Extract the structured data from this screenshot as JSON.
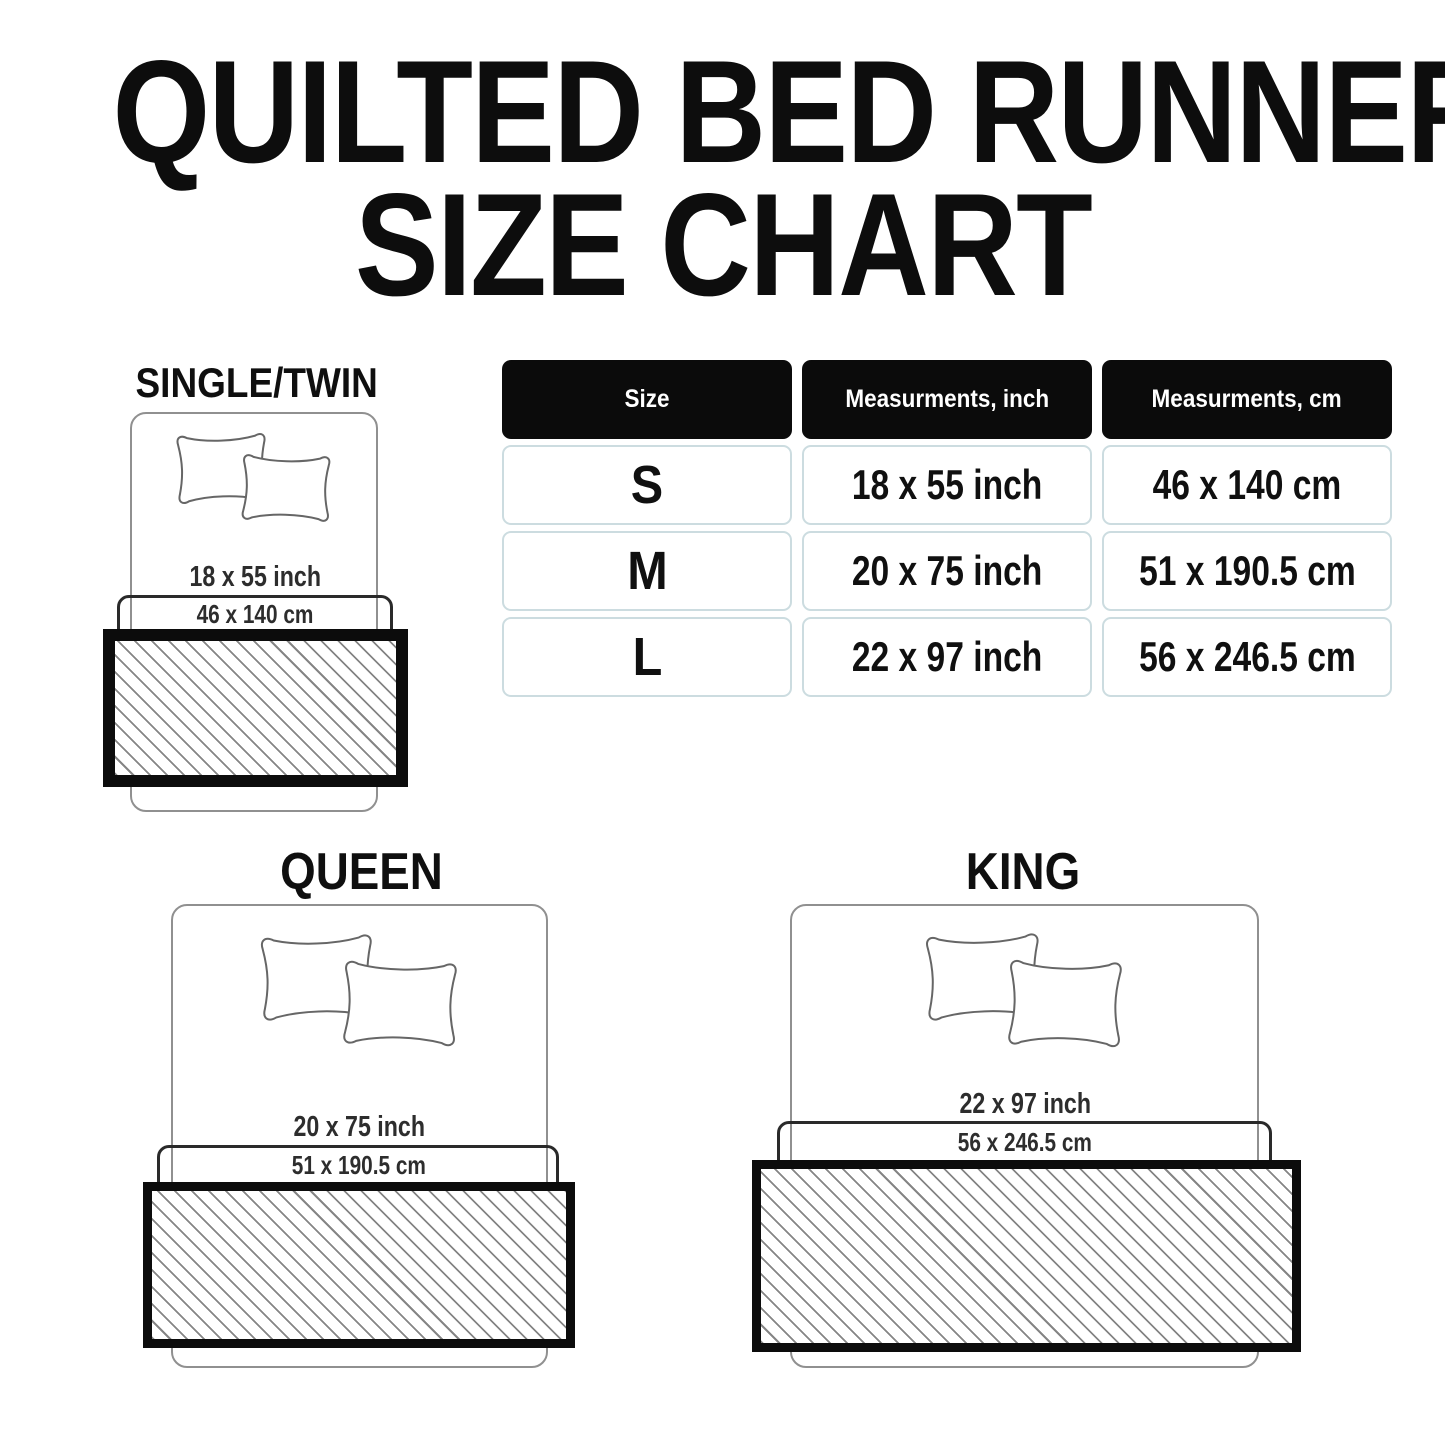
{
  "title": {
    "line1": "QUILTED BED RUNNER",
    "line2": "SIZE CHART"
  },
  "table": {
    "headers": [
      "Size",
      "Measurments, inch",
      "Measurments, cm"
    ],
    "rows": [
      {
        "size": "S",
        "inch": "18 x 55 inch",
        "cm": "46 x 140 cm"
      },
      {
        "size": "M",
        "inch": "20 x 75 inch",
        "cm": "51 x 190.5 cm"
      },
      {
        "size": "L",
        "inch": "22 x 97 inch",
        "cm": "56 x 246.5 cm"
      }
    ]
  },
  "diagrams": {
    "single": {
      "label": "SINGLE/TWIN",
      "inch": "18 x 55 inch",
      "cm": "46 x 140 cm"
    },
    "queen": {
      "label": "QUEEN",
      "inch": "20 x 75 inch",
      "cm": "51 x 190.5 cm"
    },
    "king": {
      "label": "KING",
      "inch": "22 x 97 inch",
      "cm": "56 x 246.5 cm"
    }
  },
  "colors": {
    "title_text": "#0d0d0d",
    "header_bg": "#0b0b0b",
    "header_text": "#ffffff",
    "cell_border": "#ccdce0",
    "cell_text": "#101010",
    "bed_outline": "#909090",
    "zone_outline": "#2a2a2a",
    "runner_border": "#0c0c0c",
    "hatch_line": "#858585",
    "dimension_text": "#2d2d2d"
  }
}
